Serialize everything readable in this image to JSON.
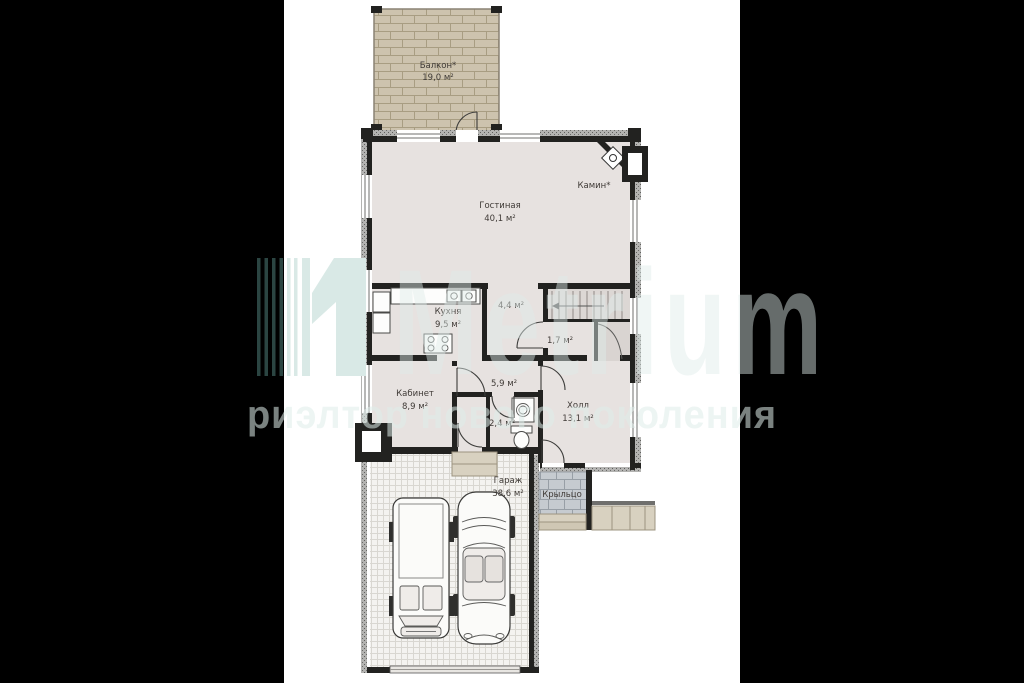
{
  "colors": {
    "background": "#000000",
    "paper": "#ffffff",
    "floor": "#e7e2e0",
    "wall": "#222220",
    "balcony_deck": "#cdc3ae",
    "porch_brick": "#c6cbd0",
    "garage_floor": "#f4f3f0",
    "watermark_teal_light": "#d9e9e6",
    "watermark_teal_dark": "#2b4542"
  },
  "watermark": {
    "logo_numeral": "1",
    "brand": "Metrium",
    "slogan": "риэлтор нового поколения"
  },
  "plan": {
    "rooms": [
      {
        "id": "balcony",
        "name": "Балкон*",
        "area": "19,0 м²"
      },
      {
        "id": "living",
        "name": "Гостиная",
        "area": "40,1 м²"
      },
      {
        "id": "kitchen",
        "name": "Кухня",
        "area": "9,5 м²"
      },
      {
        "id": "entry",
        "name": "",
        "area": "4,4 м²"
      },
      {
        "id": "wc-small",
        "name": "",
        "area": "1,7 м²"
      },
      {
        "id": "corridor",
        "name": "",
        "area": "5,9 м²"
      },
      {
        "id": "office",
        "name": "Кабинет",
        "area": "8,9 м²"
      },
      {
        "id": "bathroom",
        "name": "",
        "area": "2,4 м²"
      },
      {
        "id": "hall",
        "name": "Холл",
        "area": "13,1 м²"
      },
      {
        "id": "garage",
        "name": "Гараж",
        "area": "38,6 м²"
      },
      {
        "id": "porch",
        "name": "Крыльцо",
        "area": ""
      }
    ],
    "features": [
      {
        "id": "fireplace",
        "label": "Камин*"
      }
    ]
  }
}
